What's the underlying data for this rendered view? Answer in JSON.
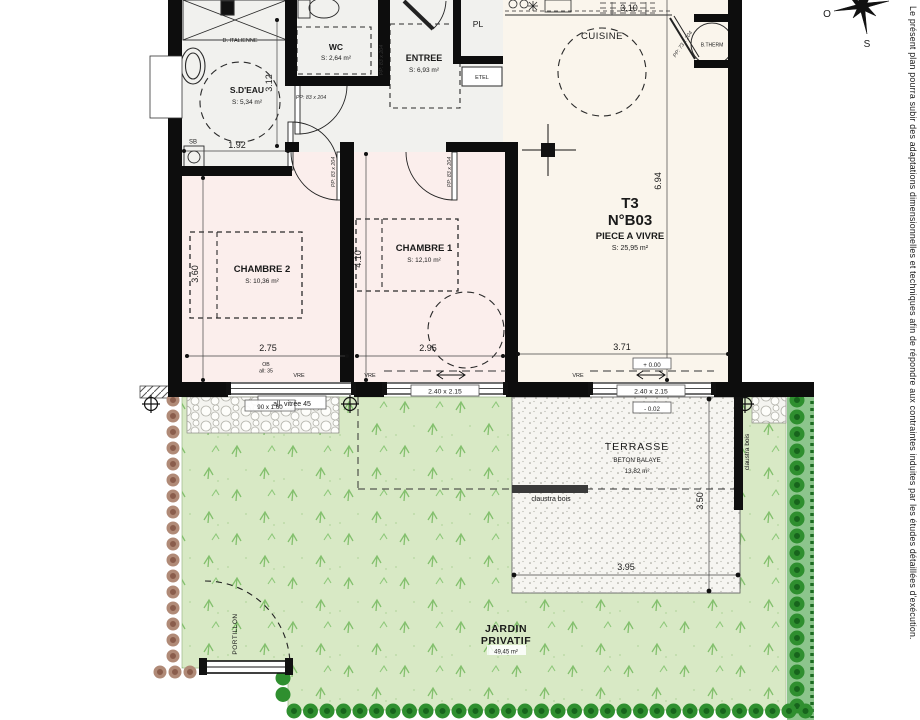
{
  "disclaimer": "Le présent plan pourra subir des adaptations dimensionnelles et techniques afin de répondre aux contraintes induites par les études détaillées d'exécution.",
  "compass": {
    "west": "O",
    "south": "S"
  },
  "unit": {
    "type": "T3",
    "number": "N°B03",
    "room": "PIECE A VIVRE",
    "area": "S: 25,95 m²"
  },
  "rooms": {
    "sdeau": {
      "name": "S.D'EAU",
      "area": "S: 5,34 m²"
    },
    "wc": {
      "name": "WC",
      "area": "S: 2,64 m²"
    },
    "entree": {
      "name": "ENTREE",
      "area": "S: 6,93 m²"
    },
    "cuisine": {
      "name": "CUISINE"
    },
    "pl": {
      "name": "PL"
    },
    "chambre1": {
      "name": "CHAMBRE 1",
      "area": "S: 12,10 m²"
    },
    "chambre2": {
      "name": "CHAMBRE 2",
      "area": "S: 10,36 m²"
    }
  },
  "fixtures": {
    "d_italienne": "D. ITALIENNE",
    "sb": "SB",
    "etel": "ETEL",
    "btherm": "B.THERM"
  },
  "openings": {
    "pp83": "PP: 83 x 204",
    "pp73": "PP: 73 x 204",
    "vre": "VRE",
    "ob": "OB",
    "all35": "all: 35",
    "all_vitree": "all. vitrée 45",
    "w90": "90 x 1.60",
    "w240": "2.40 x 2.15"
  },
  "levels": {
    "zero": "+ 0.00",
    "minus": "- 0.02"
  },
  "dims": {
    "d312": "3.12",
    "d192": "1.92",
    "d310": "3.10",
    "d694": "6.94",
    "d360": "3.60",
    "d410": "4.10",
    "d275": "2.75",
    "d295": "2.95",
    "d371": "3.71",
    "d350": "3.50",
    "d395": "3.95"
  },
  "site": {
    "terrasse": "TERRASSE",
    "beton": "BETON BALAYE",
    "terrasse_area": "13,82 m²",
    "jardin1": "JARDIN",
    "jardin2": "PRIVATIF",
    "jardin_area": "49,45 m²",
    "claustra": "claustra bois",
    "portillon": "PORTILLON"
  }
}
